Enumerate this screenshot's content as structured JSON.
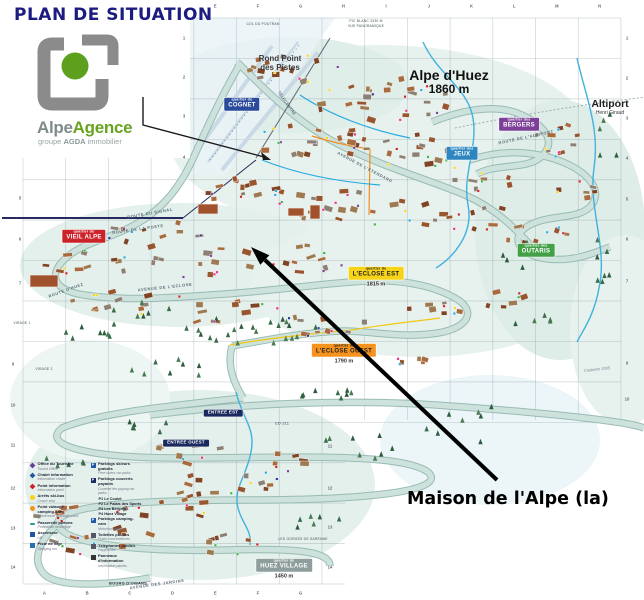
{
  "title": "PLAN DE SITUATION",
  "logo": {
    "brand_gray": "Alpe",
    "brand_green": "Agence",
    "tagline_1": "groupe",
    "tagline_2": "AGDA",
    "tagline_3": "immobilier"
  },
  "annotation": {
    "label": "Maison de l'Alpe (la)"
  },
  "map": {
    "places": {
      "rond_point_1": "Rond Point",
      "rond_point_2": "des Pistes",
      "resort": "Alpe d'Huez",
      "resort_alt": "1860 m",
      "altiport": "Altiport",
      "altiport_sub": "Henri Giraud",
      "col_du_poutran": "COL DU POUTRAN",
      "pic_blanc_1": "PIC BLANC 3330 M",
      "pic_blanc_2": "VUE PANORAMIQUE",
      "telecentre": "TELECENTRE",
      "gorges": "LES GORGES DE SARENNE",
      "bourg": "BOURG D'OISANS",
      "virage1": "VIRAGE 1",
      "virage2": "VIRAGE 2",
      "cd211": "CD 211",
      "credit": "Cadastre 2005"
    },
    "roads": [
      "ROUTE DU SIGNAL",
      "ROUTE DE LA POSTE",
      "ROUTE D'HUEZ",
      "AVENUE DE L'ECLOSE",
      "ROUTE DE L'ALTIPORT",
      "AVENUE DE L'ETENDARD",
      "AVENUE DES JARDINS"
    ],
    "badges": [
      {
        "id": "cognet",
        "pre": "quartier du",
        "name": "COGNET",
        "bg": "#2a4b9b",
        "fg": "#ffffff"
      },
      {
        "id": "jeux",
        "pre": "quartier des",
        "name": "JEUX",
        "bg": "#2e86c1",
        "fg": "#ffffff"
      },
      {
        "id": "bergers",
        "pre": "quartier des",
        "name": "BERGERS",
        "bg": "#7d3f98",
        "fg": "#ffffff"
      },
      {
        "id": "vieil-alpe",
        "pre": "quartier du",
        "name": "VIEIL ALPE",
        "bg": "#cc2229",
        "fg": "#ffffff"
      },
      {
        "id": "outaris",
        "pre": "quartier des",
        "name": "OUTARIS",
        "bg": "#43a047",
        "fg": "#ffffff"
      },
      {
        "id": "eclose-est",
        "pre": "quartier de",
        "name": "L'ECLOSE EST",
        "bg": "#f7d417",
        "fg": "#222222",
        "alt": "1815 m"
      },
      {
        "id": "eclose-ouest",
        "pre": "quartier de",
        "name": "L'ECLOSE OUEST",
        "bg": "#f6921e",
        "fg": "#222222",
        "alt": "1790 m"
      },
      {
        "id": "huez-village",
        "pre": "quartier de",
        "name": "HUEZ VILLAGE",
        "bg": "#8e9e9c",
        "fg": "#ffffff",
        "alt": "1450 m"
      },
      {
        "id": "entree-est",
        "pre": "",
        "name": "ENTREE EST",
        "bg": "#1b2a5e",
        "fg": "#ffffff"
      },
      {
        "id": "entree-ouest",
        "pre": "",
        "name": "ENTREE OUEST",
        "bg": "#1b2a5e",
        "fg": "#ffffff"
      }
    ],
    "grid": {
      "top": [
        "E",
        "F",
        "G",
        "H",
        "I",
        "J",
        "K",
        "L",
        "M",
        "N"
      ],
      "bottom": [
        "A",
        "B",
        "C",
        "D",
        "E",
        "F",
        "G"
      ],
      "right": [
        "1",
        "2",
        "3",
        "4",
        "5",
        "6",
        "7",
        "9",
        "10"
      ],
      "left_a": [
        "1",
        "2",
        "3",
        "4"
      ],
      "left_b": [
        "5",
        "6",
        "7"
      ],
      "left_c": [
        "9",
        "10",
        "11",
        "12",
        "13",
        "14"
      ],
      "mid": [
        "11",
        "12",
        "13",
        "14"
      ]
    }
  },
  "legend": {
    "col1": [
      {
        "icon": "tourist-office-icon",
        "fr": "Office du Tourisme",
        "en": "Tourist Office"
      },
      {
        "icon": "chalet-info-icon",
        "fr": "Chalet information",
        "en": "Information chalet"
      },
      {
        "icon": "info-point-icon",
        "fr": "Point information",
        "en": "Information point"
      },
      {
        "icon": "ski-bus-stop-icon",
        "fr": "Arrêts ski-bus",
        "en": "Coach stop"
      },
      {
        "icon": "motorhome-drain-icon",
        "fr": "Point vidange camping-cars",
        "en": "Motorhome drainage point"
      },
      {
        "icon": "footbridge-icon",
        "fr": "Passerelle piétons",
        "en": "Pedestrian footbridge"
      },
      {
        "icon": "lift-icon",
        "fr": "Ascenseur",
        "en": "Lift"
      },
      {
        "icon": "sledging-icon",
        "fr": "Piste de luge",
        "en": "Sledging run"
      }
    ],
    "col2": [
      {
        "icon": "free-parking-icon",
        "fr": "Parkings skieurs gratuits",
        "en": "Free skiers car parks"
      },
      {
        "icon": "paid-parking-icon",
        "fr": "Parkings couverts payants",
        "en": "Covered fee-paying car parks"
      },
      {
        "icon": "motorhome-parking-icon",
        "fr": "Parkings camping-cars",
        "en": "Motorhome park"
      },
      {
        "icon": "toilets-icon",
        "fr": "Toilettes publics",
        "en": "Public conveniences"
      },
      {
        "icon": "payphone-icon",
        "fr": "Téléphones publics",
        "en": "Payphones"
      },
      {
        "icon": "info-panel-icon",
        "fr": "Panneaux d'information",
        "en": "Information panels"
      }
    ],
    "parkings": [
      "P1 Le Coulet",
      "P2 Le Palais des Sports",
      "P3 Les Bergers",
      "P4 Huez Village"
    ]
  }
}
